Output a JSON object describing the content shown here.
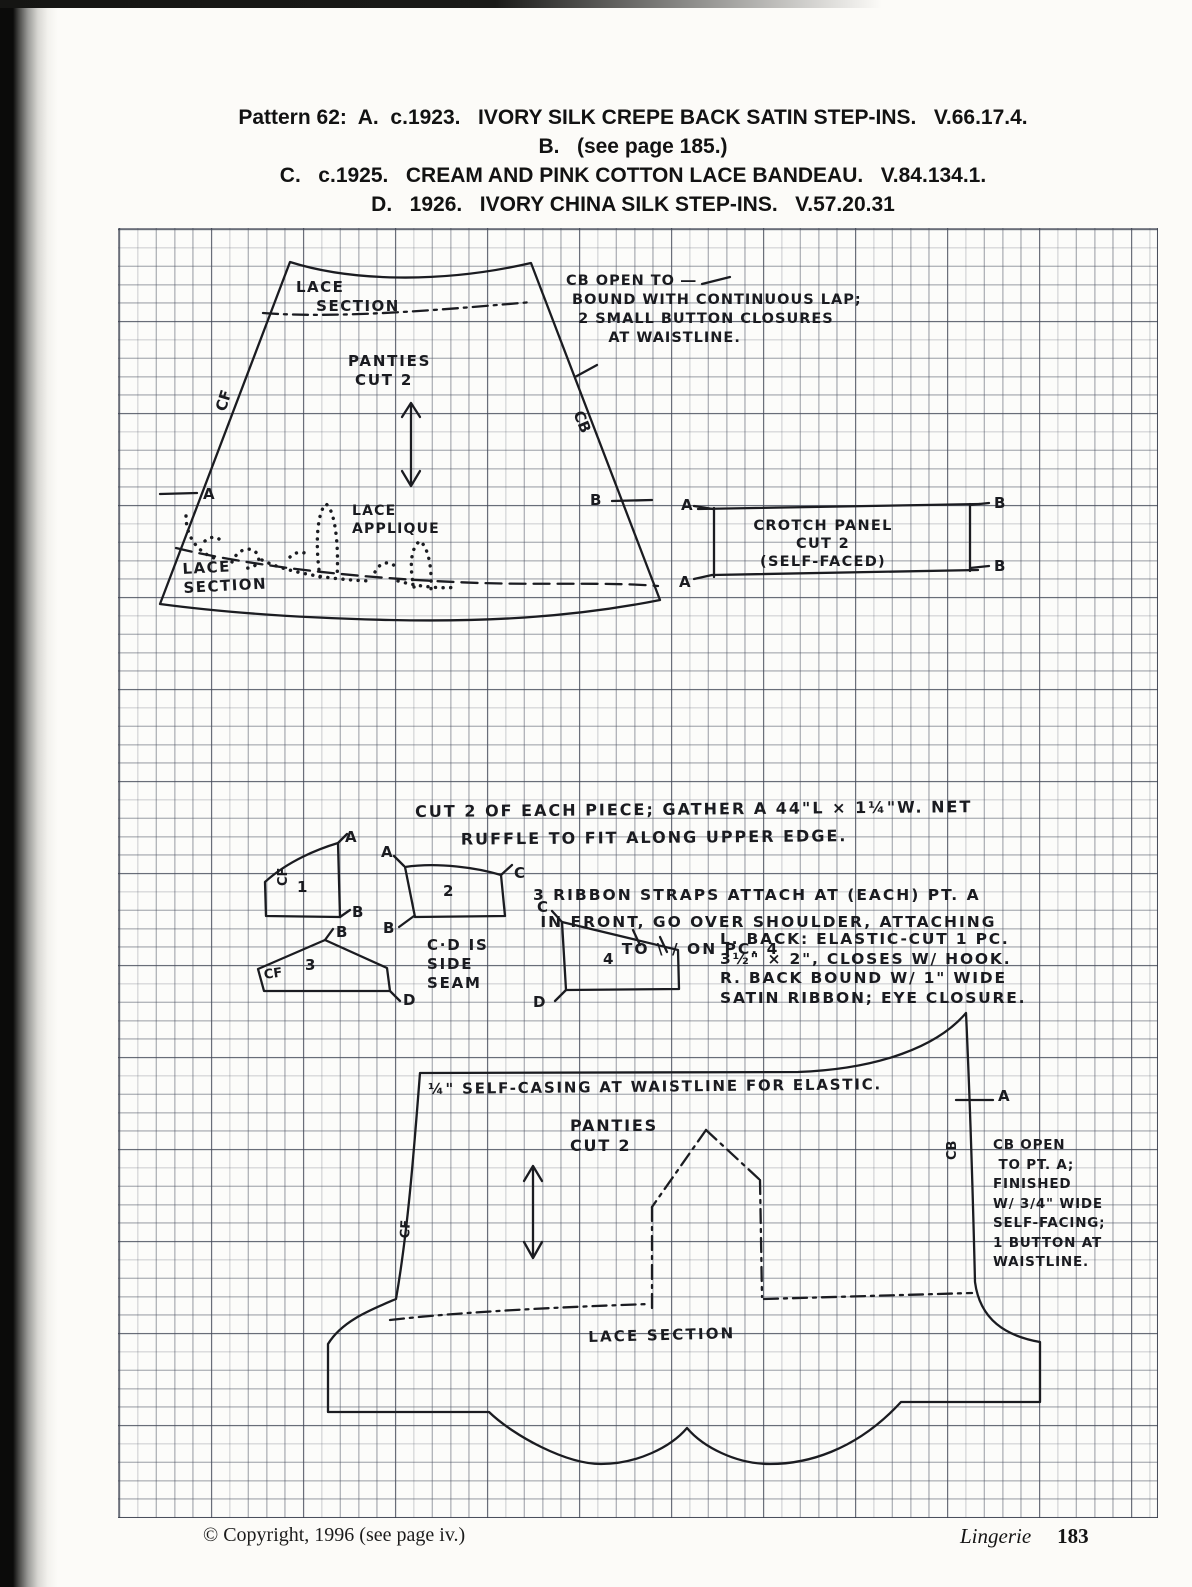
{
  "header": {
    "lines": [
      "Pattern 62:  A.  c.1923.   IVORY SILK CREPE BACK SATIN STEP-INS.   V.66.17.4.",
      "B.   (see page 185.)",
      "C.   c.1925.   CREAM AND PINK COTTON LACE BANDEAU.   V.84.134.1.",
      "D.   1926.   IVORY CHINA SILK STEP-INS.   V.57.20.31"
    ]
  },
  "diagram": {
    "lace_section_top": "LACE\n   SECTION",
    "cb_open_top": "CB OPEN TO ―\n BOUND WITH CONTINUOUS LAP;\n  2 SMALL BUTTON CLOSURES\n       AT WAISTLINE.",
    "panties_top": "PANTIES\n CUT 2",
    "cf_top": "CF",
    "cb_top": "CB",
    "pt_a_left": "A",
    "pt_b_right": "B",
    "lace_applique": "LACE\nAPPLIQUE",
    "lace_section_lower_left": "LACE\nSECTION",
    "crotch_panel": "CROTCH PANEL\nCUT 2\n(SELF-FACED)",
    "crotch_a_top": "A",
    "crotch_a_bottom": "A",
    "crotch_b_top": "B",
    "crotch_b_bottom": "B",
    "cut2_note": "CUT 2 OF EACH PIECE; GATHER A 44\"L × 1¼\"W. NET\n      RUFFLE TO FIT ALONG UPPER EDGE.",
    "ribbon_note": "3 RIBBON STRAPS ATTACH AT (EACH) PT. A\n IN FRONT, GO OVER SHOULDER, ATTACHING\n            TO \\ / ON PC. 4",
    "piece1_num": "1",
    "piece1_cf": "CF",
    "piece1_a": "A",
    "piece1_b": "B",
    "piece2_num": "2",
    "piece2_a": "A",
    "piece2_b": "B",
    "piece2_c": "C",
    "piece3_num": "3",
    "piece3_cf": "CF",
    "piece3_b": "B",
    "piece3_d": "D",
    "cd_note": "C·D IS\nSIDE\nSEAM",
    "piece4_num": "4",
    "piece4_c": "C",
    "piece4_d": "D",
    "lback_note": "L. BACK: ELASTIC-CUT 1 PC.\n3½\" × 2\", CLOSES W/ HOOK.\nR. BACK BOUND W/ 1\" WIDE\nSATIN RIBBON; EYE CLOSURE.",
    "casing_note": "¼\" SELF-CASING AT WAISTLINE FOR ELASTIC.",
    "panties_bottom": "PANTIES\nCUT 2",
    "pt_a_bottom": "A",
    "cb_bottom": "CB",
    "cb_open_bottom": "CB OPEN\n TO PT. A;\nFINISHED\nW/ 3/4\" WIDE\nSELF-FACING;\n1 BUTTON AT\nWAISTLINE.",
    "cf_bottom": "CF",
    "lace_section_bottom": "LACE SECTION"
  },
  "footer": {
    "copyright": "© Copyright, 1996 (see page iv.)",
    "running_title": "Lingerie",
    "page_number": "183"
  }
}
